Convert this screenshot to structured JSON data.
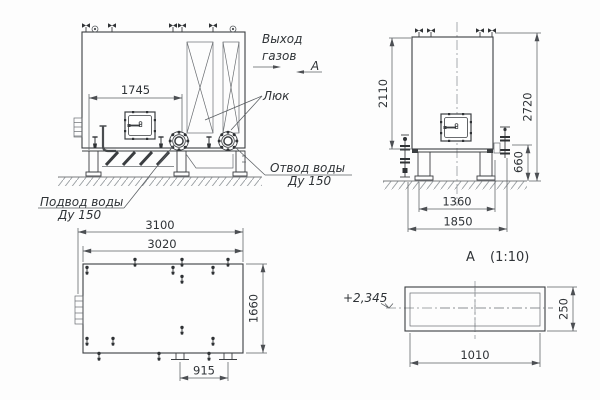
{
  "drawing_type": "technical engineering drawing, boiler/economizer unit, four views",
  "colors": {
    "outline": "#3b3e41",
    "thin_line": "#5a5e62",
    "text": "#2f3337",
    "background": "#fdfdfd"
  },
  "front_view": {
    "dim_1745": "1745",
    "label_gas_outlet": [
      "Выход",
      "газов"
    ],
    "section_letter": "А",
    "label_hatch": "Люк",
    "label_water_outlet": [
      "Отвод воды",
      "Ду 150"
    ],
    "label_water_supply": [
      "Подвод воды",
      "Ду 150"
    ]
  },
  "side_view": {
    "dim_2110": "2110",
    "dim_2720": "2720",
    "dim_660": "660",
    "dim_1360": "1360",
    "dim_1850": "1850"
  },
  "plan_view": {
    "dim_3100": "3100",
    "dim_3020": "3020",
    "dim_1660": "1660",
    "dim_915": "915"
  },
  "section_view": {
    "title": "А",
    "scale": "(1:10)",
    "level_mark": "+2,345",
    "dim_250": "250",
    "dim_1010": "1010"
  }
}
